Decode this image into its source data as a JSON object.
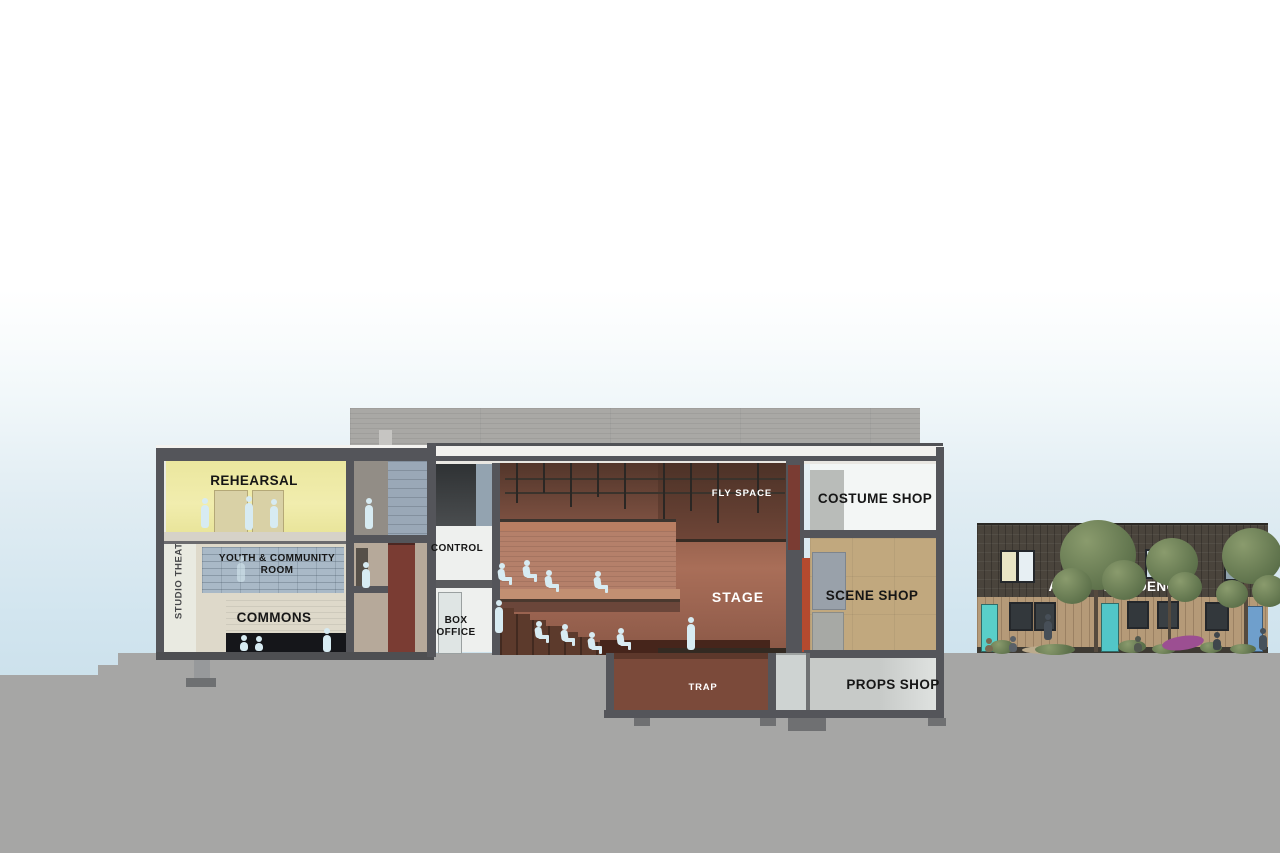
{
  "labels": {
    "studio_theatre": "STUDIO THEATRE",
    "rehearsal": "REHEARSAL",
    "youth_community": "YOUTH & COMMUNITY ROOM",
    "commons": "COMMONS",
    "control": "CONTROL",
    "box_office": "BOX OFFICE",
    "fly_space": "FLY SPACE",
    "stage": "STAGE",
    "trap": "TRAP",
    "costume_shop": "COSTUME SHOP",
    "scene_shop": "SCENE SHOP",
    "props_shop": "PROPS SHOP",
    "artist_residences": "ARTIST RESIDENCES"
  },
  "colors": {
    "sky_top": "#ffffff",
    "sky_bottom": "#cce1ec",
    "ground_gray": "#a6a6a5",
    "structure_gray": "#54555a",
    "roof_white": "#f2f1ee",
    "flytower_gray": "#a9a8a5",
    "rehearsal_yellow": "#ece9a2",
    "youth_glazing": "#a9b9c7",
    "commons_wall": "#ded9ca",
    "auditorium_brown": "#9a6350",
    "fly_space_dark": "#5f4033",
    "proscenium_red": "#b54a2f",
    "elevator_maroon": "#7a3c33",
    "trap_brown": "#7b4a3a",
    "costume_white": "#f3f6f5",
    "scene_tan": "#c1a87e",
    "props_gray": "#c7cac8",
    "residence_dark_wood": "#4a443c",
    "residence_light_wood": "#b59a78",
    "residence_door_teal": "#59cfc9",
    "figure_silhouette": "#d7ebf2"
  }
}
